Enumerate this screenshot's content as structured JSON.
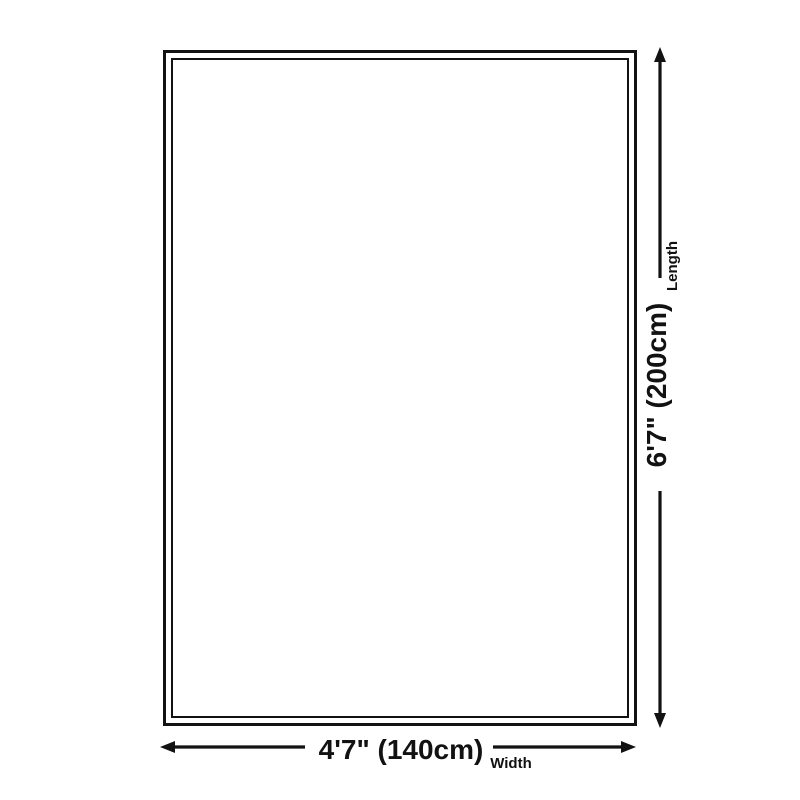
{
  "diagram": {
    "type": "product-dimension-diagram",
    "shape": "rectangle",
    "background_color": "#ffffff",
    "line_color": "#121212",
    "dimensions": {
      "length": {
        "value": "6'7\" (200cm)",
        "label": "Length",
        "orientation": "vertical"
      },
      "width": {
        "value": "4'7\" (140cm)",
        "label": "Width",
        "orientation": "horizontal"
      }
    }
  }
}
